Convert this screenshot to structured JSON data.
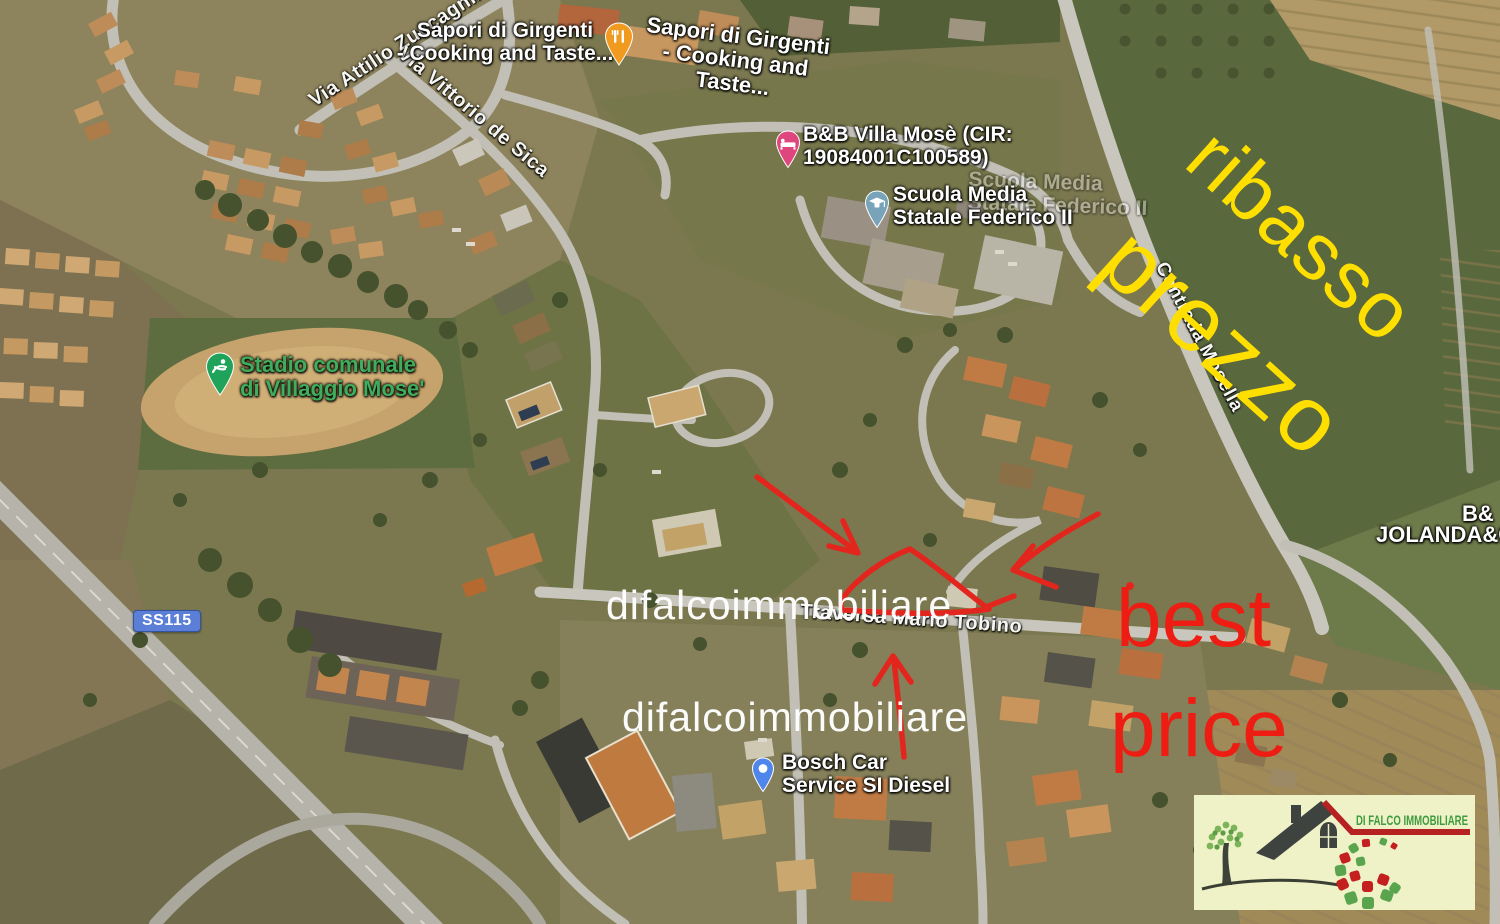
{
  "streets": {
    "zuccagnini": "Via Attilio Zuccagnini",
    "de_sica": "Via Vittorio de Sica",
    "mosella": "Contrada Mosella",
    "tobino": "Traversa Mario Tobino",
    "ss115": "SS115"
  },
  "pois": {
    "sapori_left": {
      "line1": "Sapori di Girgenti",
      "line2": "- Cooking and Taste..."
    },
    "sapori_right": {
      "line1": "Sapori di Girgenti",
      "line2": "- Cooking and Taste..."
    },
    "villa_mose": {
      "line1": "B&B Villa Mosè (CIR:",
      "line2": "19084001C100589)"
    },
    "scuola": {
      "line1": "Scuola Media",
      "line2": "Statale Federico II"
    },
    "stadio": {
      "line1": "Stadio comunale",
      "line2": "di Villaggio Mose'"
    },
    "bosch": {
      "line1": "Bosch Car",
      "line2": "Service SI Diesel"
    },
    "jolanda": {
      "line1": "B&",
      "line2": "JOLANDA&CA"
    }
  },
  "annotations": {
    "price_drop": {
      "word1": "ribasso",
      "word2": "prezzo",
      "color": "#ffdf00"
    },
    "best_price": {
      "word1": "best",
      "word2": "price",
      "color": "#ee1d14"
    },
    "watermark": {
      "text1": "difalcoimmobiliare",
      "text2": "difalcoimmobiliare",
      "color": "#ffffff"
    },
    "shapes_color": "#e3261d"
  },
  "pins": {
    "restaurant_color": "#f09a1f",
    "bnb_color": "#e0467e",
    "school_color": "#78a3b8",
    "stadium_color": "#1fa25a",
    "bosch_color": "#4f86ec"
  },
  "logo": {
    "brand_text": "DI FALCO IMMOBILIARE",
    "bg_color": "#eef2c6",
    "text_color": "#3f9b3f",
    "accent_red": "#b62121",
    "dot_green": "#5aa44e",
    "dot_red": "#c42020"
  }
}
